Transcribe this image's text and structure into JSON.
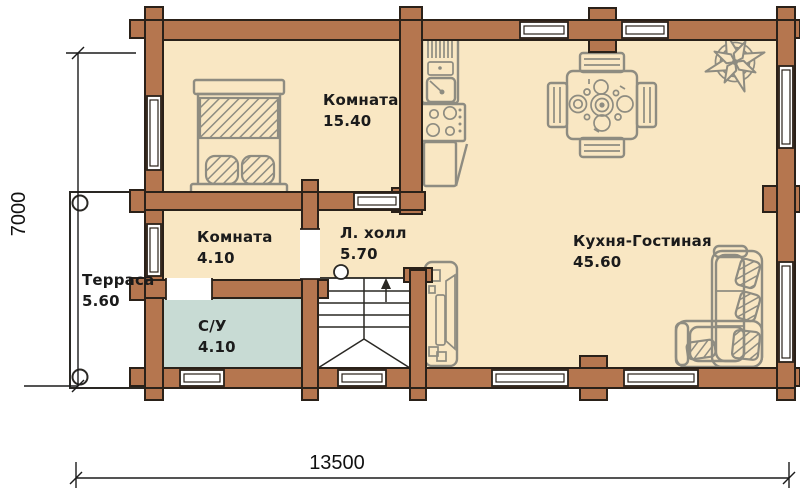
{
  "plan": {
    "rooms": [
      {
        "id": "bedroom",
        "name": "Комната",
        "area": "15.40"
      },
      {
        "id": "small-room",
        "name": "Комната",
        "area": "4.10"
      },
      {
        "id": "stair-hall",
        "name": "Л. холл",
        "area": "5.70"
      },
      {
        "id": "kitchen-living",
        "name": "Кухня-Гостиная",
        "area": "45.60"
      },
      {
        "id": "bathroom",
        "name": "С/У",
        "area": "4.10"
      },
      {
        "id": "terrace",
        "name": "Терраса",
        "area": "5.60"
      }
    ],
    "dimensions": {
      "width": "13500",
      "height": "7000"
    }
  },
  "icons": [
    "bed-icon",
    "kitchen-unit-icon",
    "dining-table-icon",
    "compass-rose-icon",
    "stairs-icon",
    "tv-unit-icon",
    "sofa-icon"
  ],
  "colors": {
    "wall": "#b5764f",
    "outline": "#2a2119",
    "floor": "#f9e7c3",
    "wet_room": "#c8dbd4",
    "furniture": "#8e8c81"
  }
}
